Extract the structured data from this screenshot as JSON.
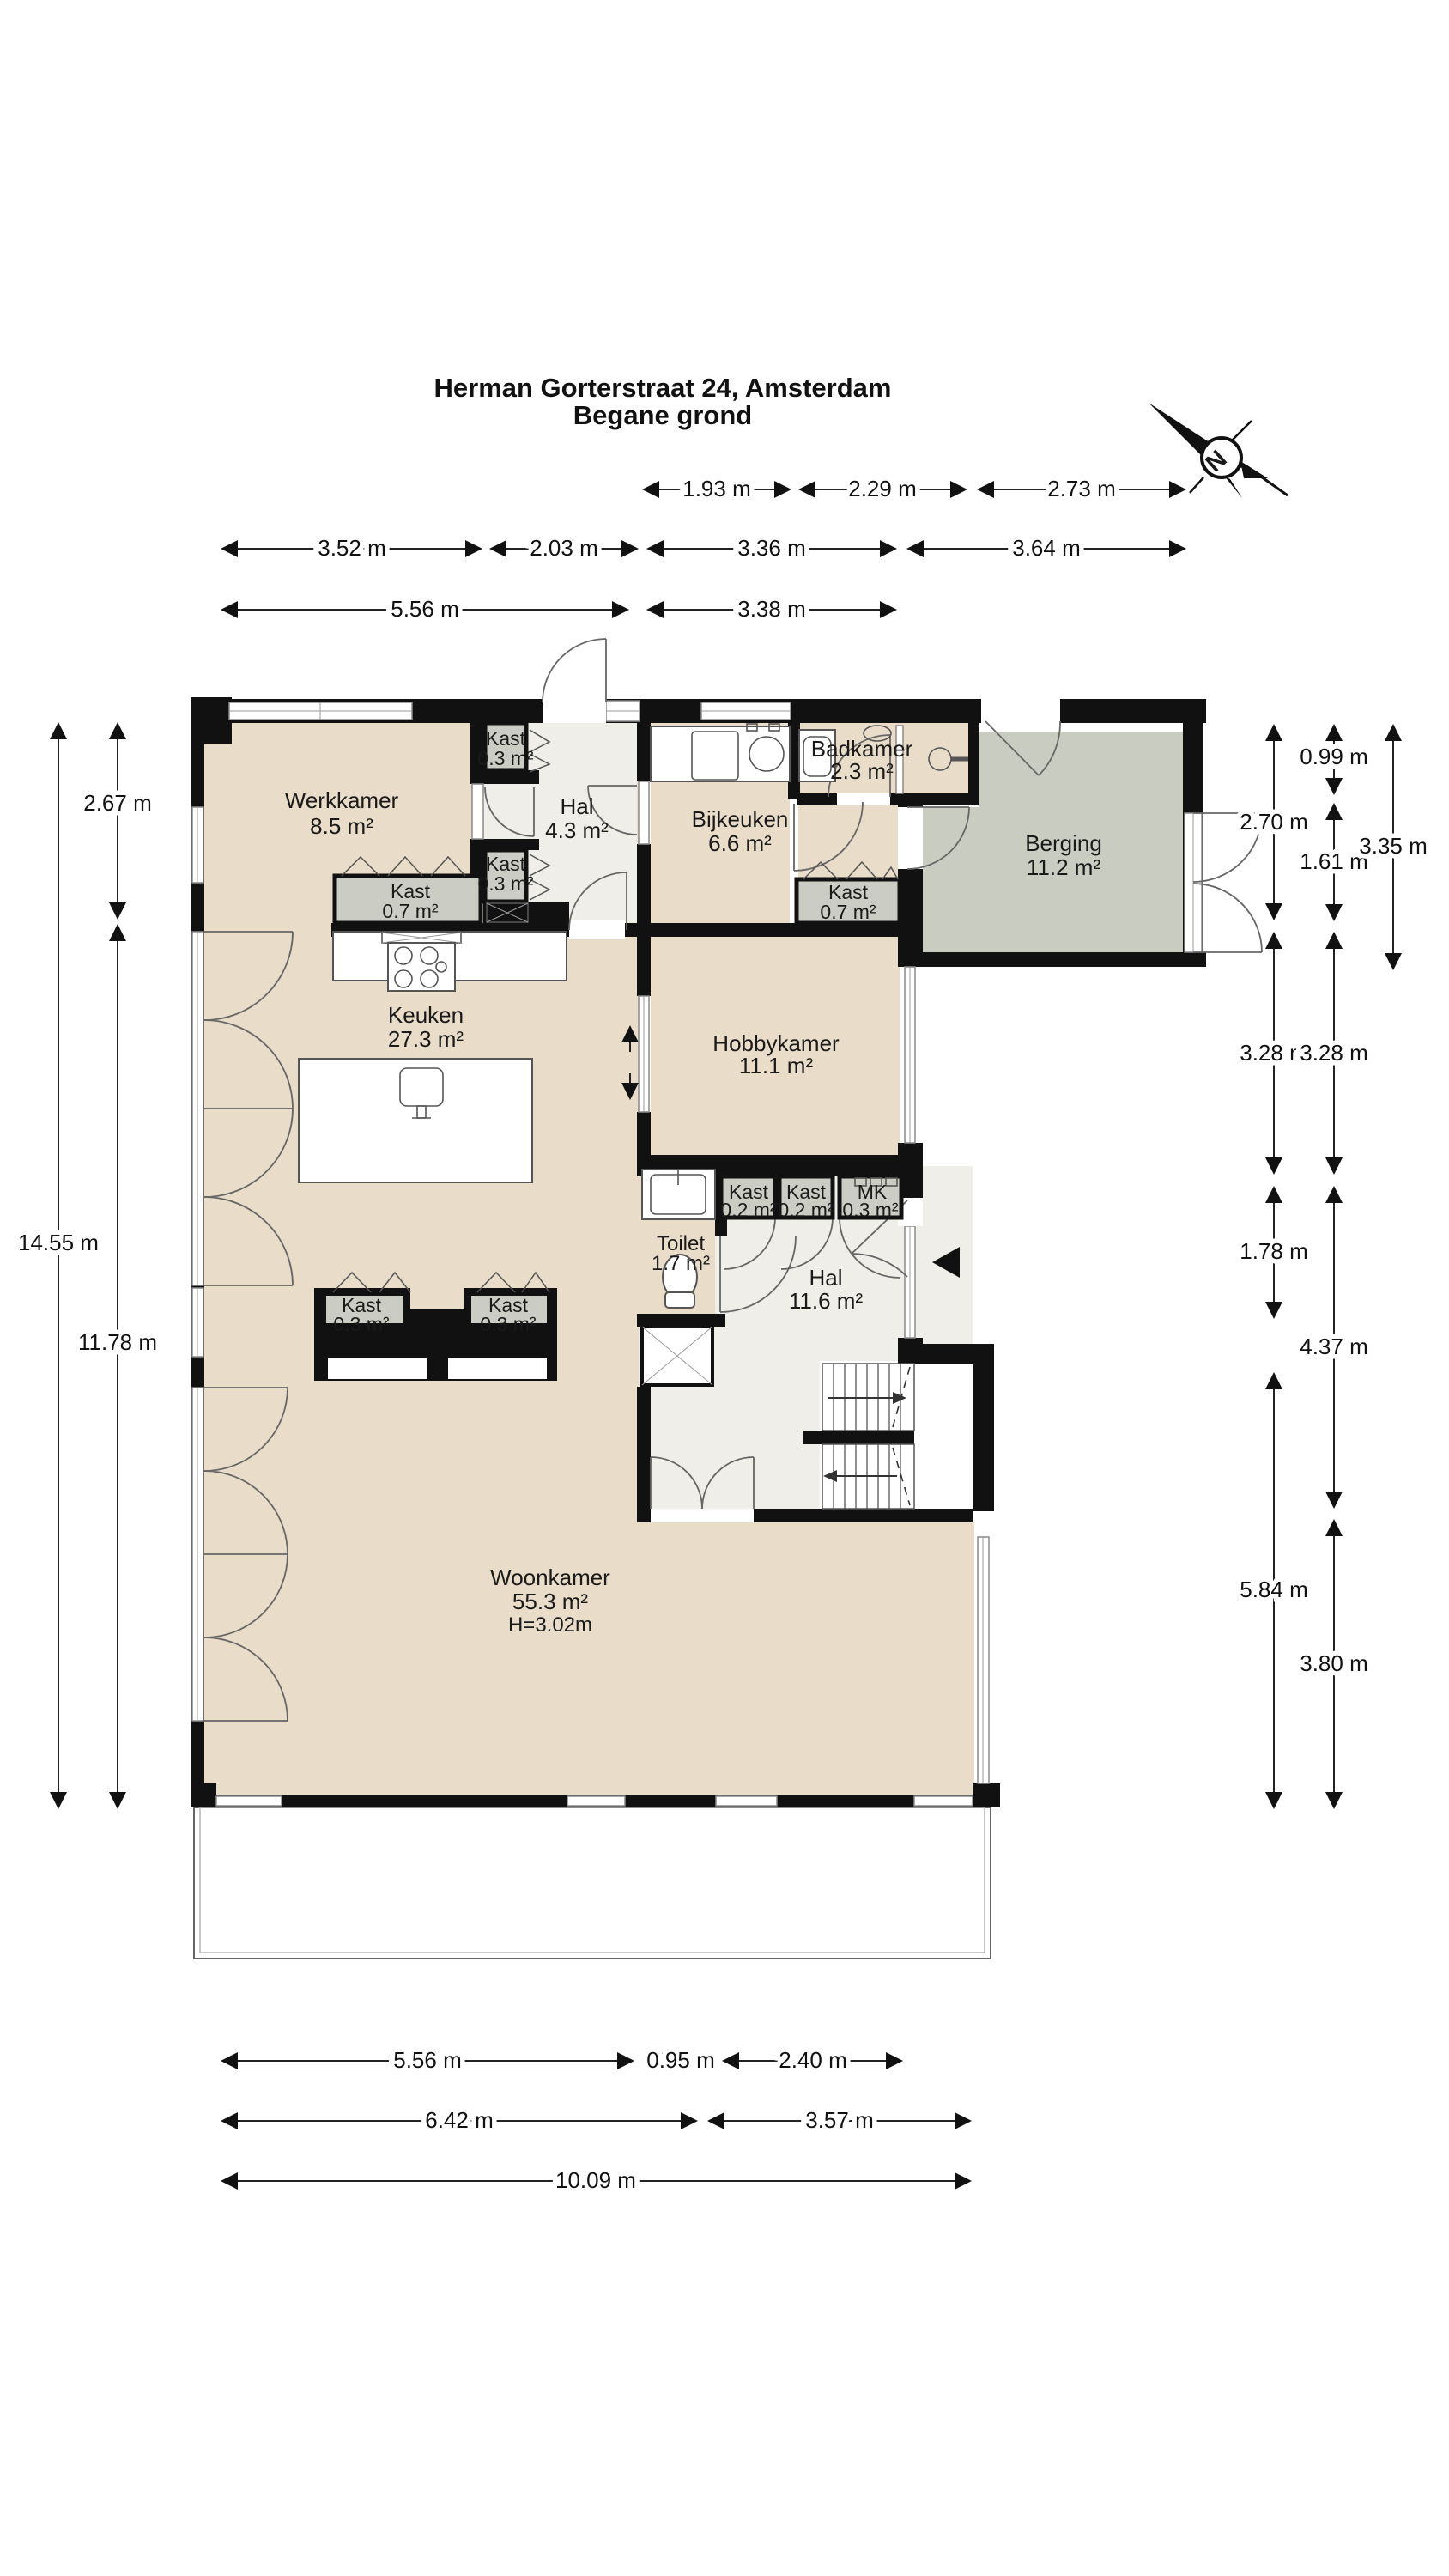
{
  "title": {
    "line1": "Herman Gorterstraat 24, Amsterdam",
    "line2": "Begane grond"
  },
  "compass": {
    "north_label": "N"
  },
  "rooms": {
    "werkkamer": {
      "name": "Werkkamer",
      "area": "8.5 m²"
    },
    "hal_boven": {
      "name": "Hal",
      "area": "4.3 m²"
    },
    "kast_boven_a": {
      "name": "Kast",
      "area": "0.3 m²"
    },
    "kast_boven_b": {
      "name": "Kast",
      "area": "0.3 m²"
    },
    "kast_werkkamer": {
      "name": "Kast",
      "area": "0.7 m²"
    },
    "bijkeuken": {
      "name": "Bijkeuken",
      "area": "6.6 m²"
    },
    "badkamer": {
      "name": "Badkamer",
      "area": "2.3 m²"
    },
    "berging": {
      "name": "Berging",
      "area": "11.2 m²"
    },
    "kast_gang": {
      "name": "Kast",
      "area": "0.7 m²"
    },
    "keuken": {
      "name": "Keuken",
      "area": "27.3 m²"
    },
    "hobbykamer": {
      "name": "Hobbykamer",
      "area": "11.1 m²"
    },
    "kast_hal_a": {
      "name": "Kast",
      "area": "0.2 m²"
    },
    "kast_hal_b": {
      "name": "Kast",
      "area": "0.2 m²"
    },
    "meterkast": {
      "name": "MK",
      "area": "0.3 m²"
    },
    "toilet": {
      "name": "Toilet",
      "area": "1.7 m²"
    },
    "hal": {
      "name": "Hal",
      "area": "11.6 m²"
    },
    "kast_divider_a": {
      "name": "Kast",
      "area": "0.3 m²"
    },
    "kast_divider_b": {
      "name": "Kast",
      "area": "0.3 m²"
    },
    "woonkamer": {
      "name": "Woonkamer",
      "area": "55.3 m²",
      "ceiling_height": "H=3.02m"
    }
  },
  "dimensions": {
    "top_row_1": [
      "1.93 m",
      "2.29 m",
      "2.73 m"
    ],
    "top_row_2": [
      "3.52 m",
      "2.03 m",
      "3.36 m",
      "3.64 m"
    ],
    "top_row_3": [
      "5.56 m",
      "3.38 m"
    ],
    "left_outer": "14.55 m",
    "left_inner_top": "2.67 m",
    "left_inner_bottom": "11.78 m",
    "right_inner": [
      "2.70 m",
      "3.28 m",
      "1.78 m",
      "5.84 m"
    ],
    "right_middle": [
      "0.99 m",
      "1.61 m",
      "3.28 m",
      "4.37 m",
      "3.80 m"
    ],
    "right_outer": "3.35 m",
    "bottom_row_1": [
      "5.56 m",
      "0.95 m",
      "2.40 m"
    ],
    "bottom_row_2": [
      "6.42 m",
      "3.57 m"
    ],
    "bottom_row_3": "10.09 m"
  },
  "colors": {
    "wall": "#111111",
    "room_beige": "#e9dcc9",
    "room_light": "#efeee8",
    "closet_gray": "#cbccc3",
    "berging_gray": "#c9ccc1",
    "text": "#1a1a1a"
  }
}
